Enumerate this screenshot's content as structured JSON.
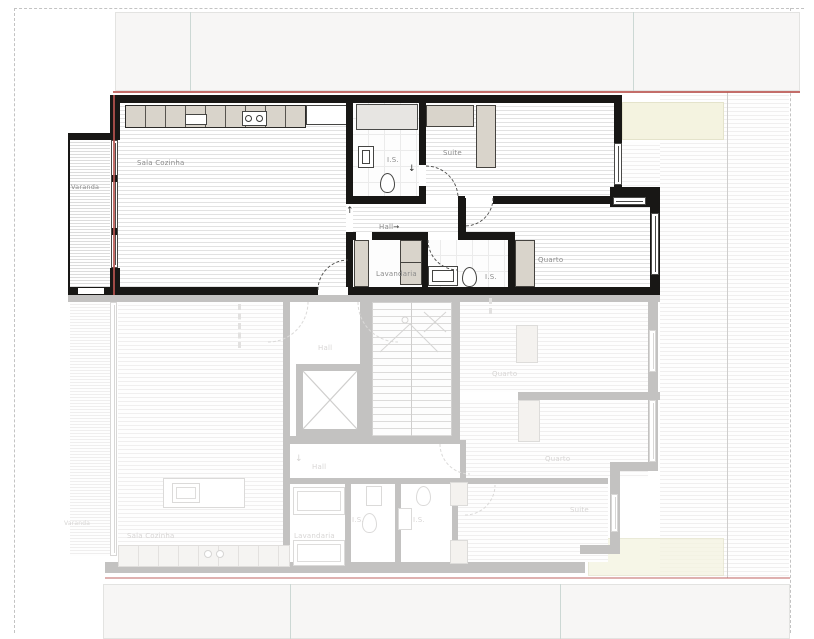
{
  "drawing": {
    "type": "apartment floor plan, active upper unit over faded lower unit"
  },
  "colors": {
    "active_wall": "#181715",
    "boundary_red": "#b9534f",
    "cabinet_beige": "#d9d4cb",
    "terrace_yellow": "#f4f3e0",
    "faded_gray": "#c3c2c1"
  },
  "icons": {
    "flow_up_arrow": "↑",
    "flow_down_arrow": "↓",
    "flow_right_arrow": "→"
  },
  "upper_floor": {
    "name": "active unit",
    "rooms": [
      {
        "label": "Varanda"
      },
      {
        "label": "Sala Cozinha"
      },
      {
        "label": "I.S."
      },
      {
        "label": "Suite"
      },
      {
        "label": "Hall"
      },
      {
        "label": "Lavandaria"
      },
      {
        "label": "I.S."
      },
      {
        "label": "Quarto"
      }
    ]
  },
  "lower_floor": {
    "name": "faded unit below",
    "rooms": [
      {
        "label": "Hall"
      },
      {
        "label": "Quarto"
      },
      {
        "label": "Quarto"
      },
      {
        "label": "Hall"
      },
      {
        "label": "Lavandaria"
      },
      {
        "label": "I.S."
      },
      {
        "label": "I.S."
      },
      {
        "label": "Suite"
      },
      {
        "label": "Sala Cozinha"
      },
      {
        "label": "Varanda"
      }
    ]
  }
}
